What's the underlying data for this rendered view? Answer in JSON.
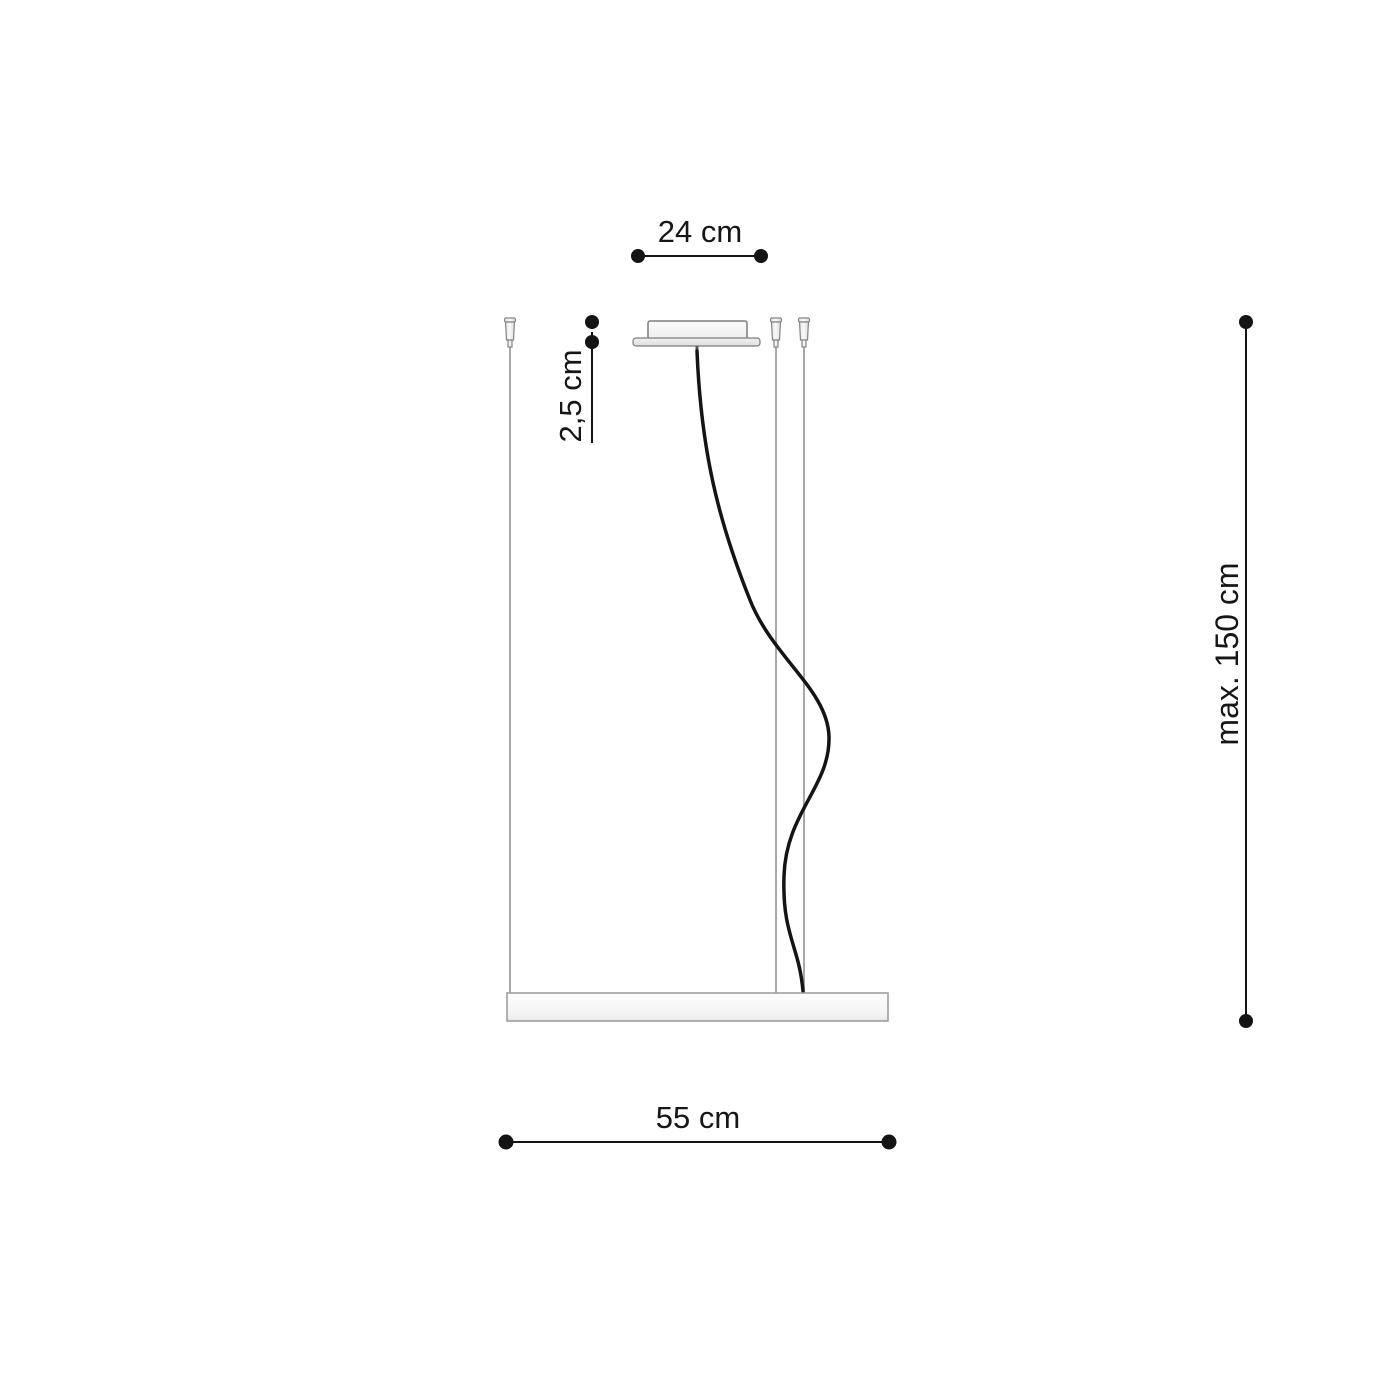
{
  "diagram": {
    "name": "pendant-lamp-dimension-diagram",
    "labels": {
      "canopy_width": "24 cm",
      "canopy_height": "2,5 cm",
      "max_drop": "max. 150 cm",
      "fixture_length": "55 cm"
    },
    "colors": {
      "dimension_line": "#141414",
      "cable": "#141414",
      "suspension_wire": "#a8a8a8",
      "hardware_outline": "#7c7c7c",
      "hardware_fill_light": "#f7f7f7",
      "hardware_fill_shade": "#e6e6e6",
      "fixture_border": "#999999",
      "background": "#ffffff"
    }
  }
}
